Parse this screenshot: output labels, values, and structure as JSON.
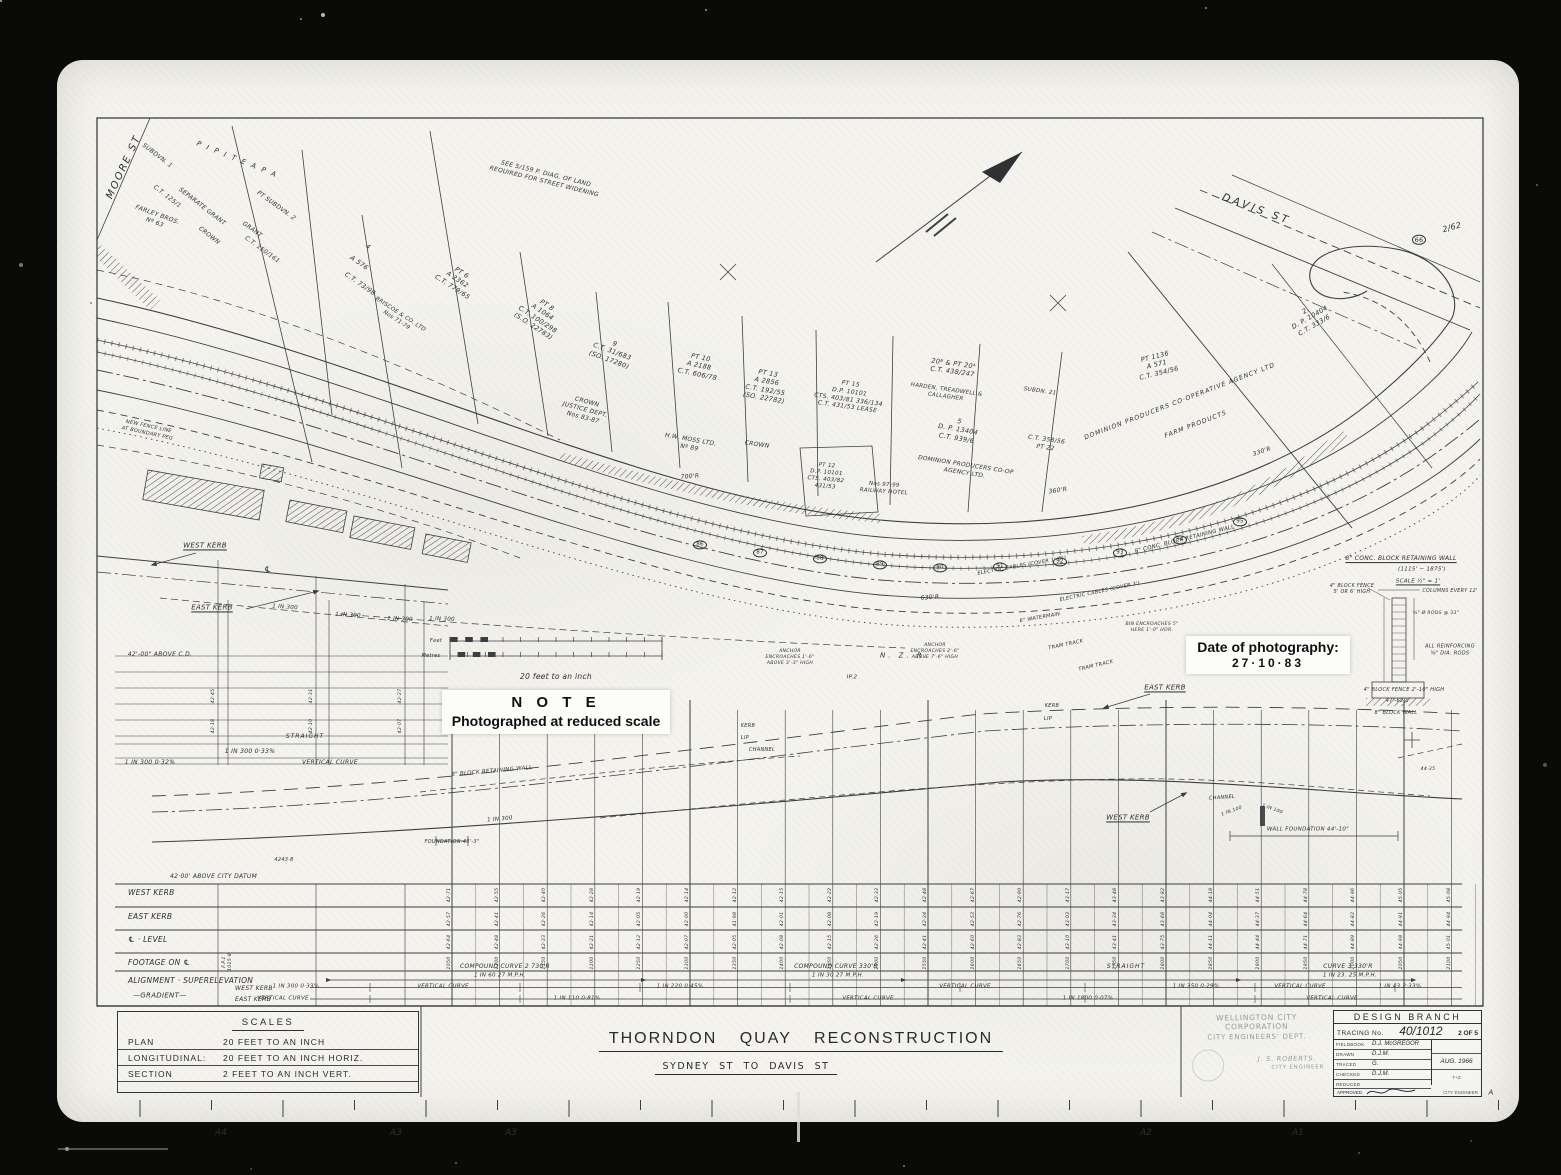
{
  "document": {
    "title": "THORNDON QUAY RECONSTRUCTION",
    "subtitle": "SYDNEY ST TO DAVIS ST"
  },
  "scales_box": {
    "title": "SCALES",
    "rows": [
      {
        "name": "PLAN",
        "value": "20 FEET TO AN INCH"
      },
      {
        "name": "LONGITUDINAL:",
        "value": "20 FEET TO AN INCH HORIZ."
      },
      {
        "name": "SECTION",
        "value": "2 FEET TO AN INCH VERT."
      }
    ]
  },
  "corporation": {
    "name": "WELLINGTON CITY CORPORATION",
    "dept": "CITY ENGINEERS' DEPT.",
    "signed": "J. S. ROBERTS.",
    "signed_title": "CITY ENGINEER"
  },
  "design_branch": {
    "title": "DESIGN BRANCH",
    "tracing_label": "TRACING No.",
    "tracing_no": "40/1012",
    "sheet": "2 OF 5",
    "date": "AUG. 1966",
    "note": "T+Z",
    "fields": [
      {
        "label": "FIELDBOOK",
        "value": "D.J. McGREGOR"
      },
      {
        "label": "DRAWN",
        "value": "D.J.M."
      },
      {
        "label": "TRACED",
        "value": "G."
      },
      {
        "label": "CHECKED",
        "value": "D.J.M."
      },
      {
        "label": "REDUCED",
        "value": ""
      }
    ],
    "approved_label": "APPROVED",
    "approver_title": "CITY ENGINEER"
  },
  "note_label": {
    "title": "N O T E",
    "body": "Photographed at reduced scale"
  },
  "photo_label": {
    "heading": "Date of photography:",
    "date": "27·10·83"
  },
  "scale_bar": {
    "feet_label": "Feet",
    "metres_label": "Metres",
    "caption": "20  feet  to  an  inch"
  },
  "profile_table": {
    "datum_note": "42·00'  ABOVE  CITY  DATUM",
    "row_labels": [
      {
        "t": "WEST   KERB",
        "y": 893
      },
      {
        "t": "EAST   KERB",
        "y": 917
      },
      {
        "t": "℄ ·  LEVEL",
        "y": 940
      },
      {
        "t": "FOOTAGE   ON   ℄",
        "y": 963
      },
      {
        "t": "ALIGNMENT · SUPERELEVATION",
        "y": 981
      }
    ],
    "gradient": {
      "label": "—GRADIENT—",
      "west": "WEST  KERB",
      "east": "EAST  KERB"
    },
    "stations": [
      1050,
      1100,
      1150,
      1200,
      1250,
      1300,
      1350,
      1400,
      1450,
      1500,
      1550,
      1600,
      1650,
      1700,
      1750,
      1800,
      1850,
      1900,
      1950,
      2000,
      2050,
      2100
    ],
    "west_levels": [
      42.71,
      42.55,
      42.4,
      42.28,
      42.19,
      42.14,
      42.12,
      42.15,
      42.22,
      42.33,
      42.48,
      42.67,
      42.9,
      43.17,
      43.48,
      43.82,
      44.18,
      44.51,
      44.78,
      44.96,
      45.05,
      45.08
    ],
    "east_levels": [
      42.57,
      42.41,
      42.26,
      42.14,
      42.05,
      42.0,
      41.98,
      42.01,
      42.08,
      42.19,
      42.34,
      42.53,
      42.76,
      43.03,
      43.34,
      43.68,
      44.04,
      44.37,
      44.64,
      44.82,
      44.91,
      44.94
    ],
    "cl_levels": [
      42.64,
      42.48,
      42.33,
      42.21,
      42.12,
      42.07,
      42.05,
      42.08,
      42.15,
      42.26,
      42.41,
      42.6,
      42.83,
      43.1,
      43.41,
      43.75,
      44.11,
      44.44,
      44.71,
      44.89,
      44.98,
      45.01
    ]
  },
  "chainage_circles": [
    {
      "n": 86,
      "x": 700,
      "y": 545
    },
    {
      "n": 87,
      "x": 760,
      "y": 553
    },
    {
      "n": 88,
      "x": 820,
      "y": 559
    },
    {
      "n": 89,
      "x": 880,
      "y": 565
    },
    {
      "n": 90,
      "x": 940,
      "y": 568
    },
    {
      "n": 91,
      "x": 1000,
      "y": 567
    },
    {
      "n": 92,
      "x": 1060,
      "y": 562
    },
    {
      "n": 93,
      "x": 1120,
      "y": 553
    },
    {
      "n": 94,
      "x": 1180,
      "y": 540
    },
    {
      "n": 95,
      "x": 1240,
      "y": 522
    }
  ],
  "plan_labels": [
    {
      "t": "MOORE  ST",
      "x": 124,
      "y": 167,
      "r": -65,
      "s": 10,
      "ls": 2
    },
    {
      "t": "DAVIS   ST",
      "x": 1256,
      "y": 210,
      "r": 20,
      "s": 10.5,
      "ls": 3
    },
    {
      "t": "SEE 5/159 P. DIAG. OF LAND\nREQUIRED FOR STREET WIDENING",
      "x": 545,
      "y": 178,
      "r": 14,
      "s": 6
    },
    {
      "t": "2/62",
      "x": 1452,
      "y": 228,
      "r": -15,
      "s": 8
    },
    {
      "t": "66",
      "x": 1419,
      "y": 240,
      "s": 6.5,
      "o": 1
    },
    {
      "t": "P I P I T E A      P A",
      "x": 237,
      "y": 160,
      "r": 22,
      "s": 7,
      "ls": 2
    },
    {
      "t": "SUBDVN. 1",
      "x": 157,
      "y": 156,
      "r": 38,
      "s": 6
    },
    {
      "t": "C.T. 125/1",
      "x": 167,
      "y": 197,
      "r": 38,
      "s": 6
    },
    {
      "t": "SEPARATE  GRANT",
      "x": 202,
      "y": 207,
      "r": 38,
      "s": 6
    },
    {
      "t": "CROWN",
      "x": 209,
      "y": 236,
      "r": 38,
      "s": 6
    },
    {
      "t": "FARLEY BROS.\nNº 63",
      "x": 156,
      "y": 219,
      "r": 20,
      "s": 6
    },
    {
      "t": "PT SUBDVN. 2",
      "x": 276,
      "y": 206,
      "r": 36,
      "s": 6
    },
    {
      "t": "GRANT",
      "x": 252,
      "y": 230,
      "r": 36,
      "s": 6
    },
    {
      "t": "C.T. 150/161",
      "x": 262,
      "y": 250,
      "r": 36,
      "s": 6
    },
    {
      "t": "4",
      "x": 368,
      "y": 247,
      "r": 35,
      "s": 6.5
    },
    {
      "t": "A 576",
      "x": 359,
      "y": 263,
      "r": 35,
      "s": 6.5
    },
    {
      "t": "C.T. 73/98",
      "x": 360,
      "y": 284,
      "r": 35,
      "s": 6.5
    },
    {
      "t": "BRISCOE & CO. LTD\nNos 71-79",
      "x": 398,
      "y": 318,
      "r": 33,
      "s": 5.5
    },
    {
      "t": "PT 6\nA 2362\nC.T. 779/65",
      "x": 457,
      "y": 280,
      "r": 33,
      "s": 6.5
    },
    {
      "t": "PT 8\nA 1064\nC.T. 100/298\n(S.O. 22783)",
      "x": 540,
      "y": 316,
      "r": 33,
      "s": 6.5
    },
    {
      "t": "9\nC.T. 31/683\n(SO. 17280)",
      "x": 612,
      "y": 352,
      "r": 20,
      "s": 6.5
    },
    {
      "t": "CROWN\nJUSTICE  DEPT.\nNos 83-87",
      "x": 585,
      "y": 410,
      "r": 15,
      "s": 6
    },
    {
      "t": "PT 10\nA 2188\nC.T. 606/78",
      "x": 699,
      "y": 366,
      "r": 12,
      "s": 6.5
    },
    {
      "t": "H.W. MOSS LTD.\nNº 89",
      "x": 690,
      "y": 444,
      "r": 10,
      "s": 6
    },
    {
      "t": "PT 13\nA 2856\nC.T. 192/55\n(SO. 22782)",
      "x": 766,
      "y": 386,
      "r": 10,
      "s": 6.5
    },
    {
      "t": "CROWN",
      "x": 757,
      "y": 445,
      "r": 8,
      "s": 6
    },
    {
      "t": "PT 15\nD.P. 10101\nCTS. 403/81 336/134\nC.T. 431/53 LEASE",
      "x": 849,
      "y": 396,
      "r": 8,
      "s": 6
    },
    {
      "t": "PT 12\nD.P. 10101\nCTS. 403/82\n431/53",
      "x": 826,
      "y": 477,
      "r": 5,
      "s": 5.5
    },
    {
      "t": "Nos 97-99\nRAILWAY HOTEL",
      "x": 884,
      "y": 489,
      "r": 4,
      "s": 5.5
    },
    {
      "t": "20ᴮ & PT 20ᴬ\nC.T. 438/247",
      "x": 953,
      "y": 368,
      "r": 8,
      "s": 6.5
    },
    {
      "t": "HARDEN, TREADWELL &\nCALLAGHER",
      "x": 946,
      "y": 394,
      "r": 8,
      "s": 5.5
    },
    {
      "t": "SUBDN. 21",
      "x": 1040,
      "y": 392,
      "r": 8,
      "s": 5.5
    },
    {
      "t": "5\nD. P. 13404\nC.T. 939/6",
      "x": 958,
      "y": 430,
      "r": 10,
      "s": 6.5
    },
    {
      "t": "DOMINION PRODUCERS CO-OP\nAGENCY LTD.",
      "x": 965,
      "y": 470,
      "r": 9,
      "s": 5.8
    },
    {
      "t": "C.T. 358/56\nPT 22",
      "x": 1046,
      "y": 444,
      "r": 8,
      "s": 6
    },
    {
      "t": "DOMINION    PRODUCERS    CO·OPERATIVE    AGENCY    LTD",
      "x": 1180,
      "y": 402,
      "r": -21,
      "s": 6.2,
      "ls": 1
    },
    {
      "t": "FARM    PRODUCTS",
      "x": 1196,
      "y": 425,
      "r": -21,
      "s": 6.2,
      "ls": 1
    },
    {
      "t": "PT 1136\nA 571\nC.T. 354/56",
      "x": 1157,
      "y": 365,
      "r": -14,
      "s": 6.5
    },
    {
      "t": "2.\nD. P. 10404\nC.T. 333/6",
      "x": 1310,
      "y": 318,
      "r": -30,
      "s": 6.5
    },
    {
      "t": "NEW FENCE LINE\nAT BOUNDARY PEG",
      "x": 148,
      "y": 430,
      "r": 12,
      "s": 5
    },
    {
      "t": "700'R",
      "x": 690,
      "y": 477,
      "r": -4,
      "s": 6
    },
    {
      "t": "360'R",
      "x": 1058,
      "y": 491,
      "r": -8,
      "s": 6
    },
    {
      "t": "630'R",
      "x": 930,
      "y": 598,
      "r": -4,
      "s": 6
    },
    {
      "t": "330'R",
      "x": 1262,
      "y": 452,
      "r": -18,
      "s": 6
    },
    {
      "t": "8\" CONC. BLOCK RETAINING WALL",
      "x": 1185,
      "y": 540,
      "r": -14,
      "s": 5.5
    },
    {
      "t": "ELECTRIC CABLES (COVER 1'-6\")",
      "x": 1022,
      "y": 566,
      "r": -10,
      "s": 5
    },
    {
      "t": "ELECTRIC CABLES (COVER 3')",
      "x": 1100,
      "y": 592,
      "r": -12,
      "s": 5
    },
    {
      "t": "6\" WATERMAIN",
      "x": 1040,
      "y": 618,
      "r": -10,
      "s": 5
    },
    {
      "t": "TRAM  TRACK",
      "x": 1066,
      "y": 645,
      "r": -12,
      "s": 5
    },
    {
      "t": "TRAM  TRACK",
      "x": 1096,
      "y": 666,
      "r": -13,
      "s": 5
    },
    {
      "t": "N.   Z.   R.",
      "x": 905,
      "y": 656,
      "s": 7,
      "ls": 3
    },
    {
      "t": "ANCHOR\nENCROACHES 1'-6\"\nABOVE 3'-3\" HIGH",
      "x": 790,
      "y": 658,
      "s": 4.6
    },
    {
      "t": "ANCHOR\nENCROACHES 2'-6\"\nABOVE 7'-6\" HIGH",
      "x": 935,
      "y": 652,
      "s": 4.6
    },
    {
      "t": "BIN ENCROACHES 5\"\nHERE 1'-0\" HOR.",
      "x": 1152,
      "y": 628,
      "s": 4.6
    },
    {
      "t": "IP.2",
      "x": 852,
      "y": 678,
      "s": 5.5
    },
    {
      "t": "KERB",
      "x": 748,
      "y": 726,
      "s": 5
    },
    {
      "t": "LIP",
      "x": 745,
      "y": 738,
      "s": 5
    },
    {
      "t": "CHANNEL",
      "x": 762,
      "y": 750,
      "s": 5
    },
    {
      "t": "KERB",
      "x": 1052,
      "y": 706,
      "s": 5
    },
    {
      "t": "LIP",
      "x": 1048,
      "y": 719,
      "s": 5
    },
    {
      "t": "EAST   KERB",
      "x": 1165,
      "y": 688,
      "s": 7,
      "u": 1
    },
    {
      "t": "WEST   KERB",
      "x": 1128,
      "y": 818,
      "s": 7,
      "u": 1
    },
    {
      "t": "CHANNEL",
      "x": 1222,
      "y": 798,
      "r": -4,
      "s": 5
    },
    {
      "t": "1 IN 100",
      "x": 1232,
      "y": 812,
      "r": -20,
      "s": 4.6
    },
    {
      "t": "1 IN 100",
      "x": 1272,
      "y": 810,
      "r": 20,
      "s": 4.6
    },
    {
      "t": "WALL  FOUNDATION  44'-10\"",
      "x": 1308,
      "y": 830,
      "s": 5.5
    },
    {
      "t": "44·35",
      "x": 1428,
      "y": 770,
      "s": 4.6
    },
    {
      "t": "8\" BLOCK RETAINING WALL",
      "x": 492,
      "y": 772,
      "r": -5,
      "s": 5.5
    },
    {
      "t": "FOUNDATION 43'-3\"",
      "x": 452,
      "y": 842,
      "s": 5
    },
    {
      "t": "4243·8",
      "x": 284,
      "y": 860,
      "s": 5
    },
    {
      "t": "1 IN 300",
      "x": 500,
      "y": 820,
      "r": -5,
      "s": 5.5
    },
    {
      "t": "1 IN 300",
      "x": 285,
      "y": 608,
      "r": 4,
      "s": 5.5
    },
    {
      "t": "1 IN 300",
      "x": 348,
      "y": 616,
      "r": 3,
      "s": 5.5
    },
    {
      "t": "1 IN 300",
      "x": 400,
      "y": 620,
      "r": 2,
      "s": 5.5
    },
    {
      "t": "1 IN 300",
      "x": 442,
      "y": 620,
      "r": 2,
      "s": 5.5
    },
    {
      "t": "WEST  KERB",
      "x": 205,
      "y": 546,
      "s": 7,
      "u": 1
    },
    {
      "t": "EAST  KERB",
      "x": 212,
      "y": 608,
      "s": 7,
      "u": 1
    },
    {
      "t": "℄",
      "x": 268,
      "y": 570,
      "s": 8
    },
    {
      "t": "42'-00\" ABOVE C.D.",
      "x": 160,
      "y": 655,
      "s": 6
    },
    {
      "t": "STRAIGHT",
      "x": 305,
      "y": 737,
      "s": 6,
      "ls": 1
    },
    {
      "t": "1  IN  300        0·33%",
      "x": 250,
      "y": 752,
      "s": 6
    },
    {
      "t": "1  IN  300     0·32%",
      "x": 150,
      "y": 763,
      "s": 6
    },
    {
      "t": "VERTICAL   CURVE",
      "x": 330,
      "y": 763,
      "s": 6
    },
    {
      "t": "42·45",
      "x": 214,
      "y": 696,
      "r": -90,
      "s": 4.6
    },
    {
      "t": "42·31",
      "x": 312,
      "y": 696,
      "r": -90,
      "s": 4.6
    },
    {
      "t": "42·27",
      "x": 401,
      "y": 696,
      "r": -90,
      "s": 4.6
    },
    {
      "t": "42·18",
      "x": 214,
      "y": 726,
      "r": -90,
      "s": 4.6
    },
    {
      "t": "42·10",
      "x": 312,
      "y": 726,
      "r": -90,
      "s": 4.6
    },
    {
      "t": "42·07",
      "x": 401,
      "y": 726,
      "r": -90,
      "s": 4.6
    },
    {
      "t": "F.P.1\n1015·8",
      "x": 228,
      "y": 962,
      "r": -90,
      "s": 4.6
    },
    {
      "t": "COMPOUND   CURVE  2        730'R",
      "x": 505,
      "y": 967,
      "s": 6
    },
    {
      "t": "1 IN 60        27 M.P.H.",
      "x": 500,
      "y": 976,
      "s": 5.5
    },
    {
      "t": "COMPOUND  CURVE   330'R",
      "x": 836,
      "y": 967,
      "s": 6
    },
    {
      "t": "1 IN 30      27 M.P.H.",
      "x": 838,
      "y": 976,
      "s": 5.5
    },
    {
      "t": "STRAIGHT",
      "x": 1126,
      "y": 967,
      "s": 6,
      "ls": 1
    },
    {
      "t": "CURVE   3      330'R",
      "x": 1348,
      "y": 967,
      "s": 6
    },
    {
      "t": "1 IN 23.    25 M.P.H.",
      "x": 1350,
      "y": 976,
      "s": 5.5
    },
    {
      "t": "1 IN 300   0·33%",
      "x": 296,
      "y": 987,
      "s": 5.5
    },
    {
      "t": "VERTICAL    CURVE",
      "x": 443,
      "y": 987,
      "s": 5.5
    },
    {
      "t": "1  IN  220      0·45%",
      "x": 680,
      "y": 987,
      "s": 5.5
    },
    {
      "t": "VERTICAL   CURVE",
      "x": 965,
      "y": 987,
      "s": 5.5
    },
    {
      "t": "1  IN  350      0·29%",
      "x": 1196,
      "y": 987,
      "s": 5.5
    },
    {
      "t": "VERTICAL   CURVE",
      "x": 1300,
      "y": 987,
      "s": 5.5
    },
    {
      "t": "1 IN 43    2·33%",
      "x": 1400,
      "y": 987,
      "s": 5.5
    },
    {
      "t": "VERTICAL    CURVE",
      "x": 283,
      "y": 999,
      "s": 5.5
    },
    {
      "t": "1  IN  110      0·81%",
      "x": 577,
      "y": 999,
      "s": 5.5
    },
    {
      "t": "VERTICAL   CURVE",
      "x": 868,
      "y": 999,
      "s": 5.5
    },
    {
      "t": "1  IN  1800      0·07%",
      "x": 1088,
      "y": 999,
      "s": 5.5
    },
    {
      "t": "VERTICAL   CURVE",
      "x": 1332,
      "y": 999,
      "s": 5.5
    },
    {
      "t": "8\" CONC. BLOCK RETAINING WALL",
      "x": 1401,
      "y": 559,
      "s": 6,
      "u": 1
    },
    {
      "t": "(1115' − 1875')",
      "x": 1422,
      "y": 570,
      "s": 5.5
    },
    {
      "t": "SCALE  ½\" = 1'",
      "x": 1418,
      "y": 582,
      "s": 5.5,
      "u": 1
    },
    {
      "t": "4\" BLOCK FENCE\n5' OR 6' HIGH",
      "x": 1352,
      "y": 590,
      "s": 4.8
    },
    {
      "t": "COLUMNS EVERY 12'",
      "x": 1450,
      "y": 592,
      "s": 4.8
    },
    {
      "t": "⅝\" Ø RODS @ 33\"",
      "x": 1436,
      "y": 614,
      "s": 4.6
    },
    {
      "t": "ALL REINFORCING\n⅝\" DIA. RODS",
      "x": 1450,
      "y": 650,
      "s": 5
    },
    {
      "t": "4\" BLOCK FENCE 2'-10\" HIGH",
      "x": 1404,
      "y": 690,
      "s": 5
    },
    {
      "t": "47'-62½'",
      "x": 1398,
      "y": 701,
      "s": 5
    },
    {
      "t": "8\" BLOCK WALL",
      "x": 1396,
      "y": 713,
      "s": 5
    },
    {
      "t": "A",
      "x": 1491,
      "y": 1093,
      "s": 7
    }
  ],
  "scan": {
    "ruler_marks": [
      {
        "t": "A4",
        "x": 215
      },
      {
        "t": "A3",
        "x": 390
      },
      {
        "t": "A3",
        "x": 505
      },
      {
        "t": "A2",
        "x": 1140
      },
      {
        "t": "A1",
        "x": 1292
      }
    ]
  }
}
